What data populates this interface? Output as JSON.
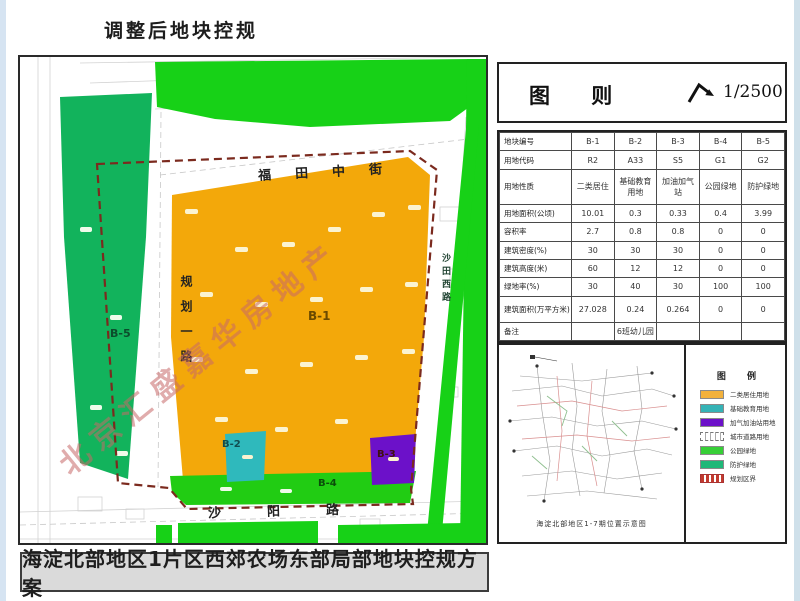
{
  "page": {
    "title": "调整后地块控规",
    "banner": "海淀北部地区1片区西郊农场东部局部地块控规方案",
    "watermark": "北京汇盛嘉华房地产"
  },
  "map": {
    "streets": {
      "north": "福田中街",
      "west": "规划一路",
      "east": "沙田西路",
      "south": "沙阳路"
    },
    "parcels": [
      {
        "id": "B-1",
        "use": "二类居住",
        "color": "#F3A80A"
      },
      {
        "id": "B-2",
        "use": "基础教育用地",
        "color": "#2FB9BC"
      },
      {
        "id": "B-3",
        "use": "加油加气站",
        "color": "#6C11C9"
      },
      {
        "id": "B-4",
        "use": "公园绿地",
        "color": "#21CC13"
      },
      {
        "id": "B-5",
        "use": "防护绿地",
        "color": "#12B35C"
      }
    ]
  },
  "panel": {
    "header": {
      "title": "图 则",
      "scale": "1/2500",
      "north_arrow": "north-arrow-icon"
    },
    "table": {
      "rows": [
        {
          "label": "地块编号",
          "values": [
            "B-1",
            "B-2",
            "B-3",
            "B-4",
            "B-5"
          ]
        },
        {
          "label": "用地代码",
          "values": [
            "R2",
            "A33",
            "S5",
            "G1",
            "G2"
          ]
        },
        {
          "label": "用地性质",
          "values": [
            "二类居住",
            "基础教育用地",
            "加油加气站",
            "公园绿地",
            "防护绿地"
          ]
        },
        {
          "label": "用地面积(公顷)",
          "values": [
            "10.01",
            "0.3",
            "0.33",
            "0.4",
            "3.99"
          ]
        },
        {
          "label": "容积率",
          "values": [
            "2.7",
            "0.8",
            "0.8",
            "0",
            "0"
          ]
        },
        {
          "label": "建筑密度(%)",
          "values": [
            "30",
            "30",
            "30",
            "0",
            "0"
          ]
        },
        {
          "label": "建筑高度(米)",
          "values": [
            "60",
            "12",
            "12",
            "0",
            "0"
          ]
        },
        {
          "label": "绿地率(%)",
          "values": [
            "30",
            "40",
            "30",
            "100",
            "100"
          ]
        },
        {
          "label": "建筑面积(万平方米)",
          "values": [
            "27.028",
            "0.24",
            "0.264",
            "0",
            "0"
          ]
        },
        {
          "label": "备注",
          "values": [
            "",
            "6班幼儿园",
            "",
            "",
            ""
          ]
        }
      ]
    },
    "inset": {
      "caption": "海淀北部地区1-7期位置示意图"
    },
    "legend": {
      "title": "图 例",
      "items": [
        {
          "label": "二类居住用地",
          "color": "#F2B13C"
        },
        {
          "label": "基础教育用地",
          "color": "#35B3B6"
        },
        {
          "label": "加气加油站用地",
          "color": "#6C11C9"
        },
        {
          "label": "城市道路用地",
          "color": "#FFFFFF"
        },
        {
          "label": "公园绿地",
          "color": "#37CF37"
        },
        {
          "label": "防护绿地",
          "color": "#1FB878"
        },
        {
          "label": "规划区界",
          "color": "#C23B2E"
        }
      ]
    }
  }
}
